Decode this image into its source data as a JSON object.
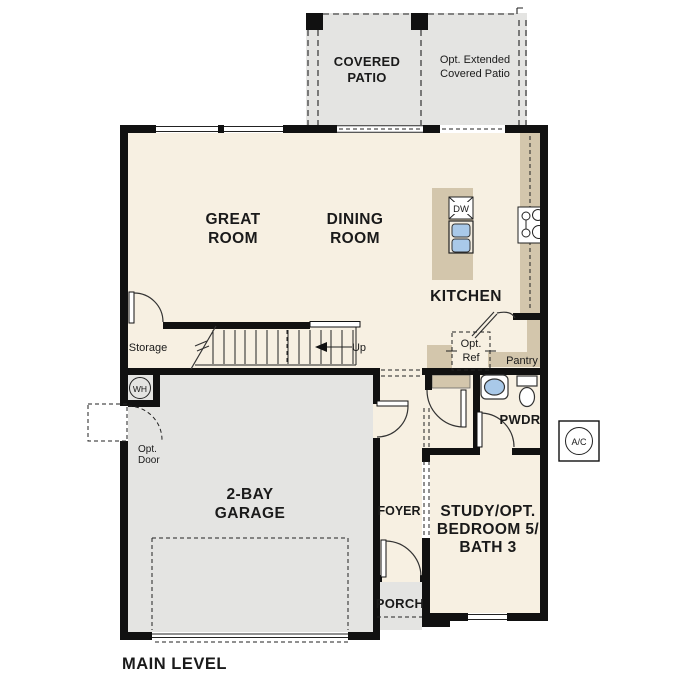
{
  "plan_title": "MAIN LEVEL",
  "colors": {
    "floor": "#f7f0e2",
    "concrete": "#e4e4e2",
    "counter": "#d3c6ac",
    "wall": "#111111",
    "fixture_blue": "#a9c9e9",
    "optref_fill": "#e8e8e6"
  },
  "areas": {
    "covered_patio": {
      "line1": "COVERED",
      "line2": "PATIO"
    },
    "extended_patio": {
      "line1": "Opt. Extended",
      "line2": "Covered Patio"
    },
    "great_room": {
      "line1": "GREAT",
      "line2": "ROOM"
    },
    "dining_room": {
      "line1": "DINING",
      "line2": "ROOM"
    },
    "kitchen": {
      "label": "KITCHEN"
    },
    "pantry": {
      "label": "Pantry"
    },
    "powder": {
      "label": "PWDR"
    },
    "storage": {
      "label": "Storage"
    },
    "garage": {
      "line1": "2-BAY",
      "line2": "GARAGE"
    },
    "foyer": {
      "label": "FOYER"
    },
    "study": {
      "line1": "STUDY/OPT.",
      "line2": "BEDROOM 5/",
      "line3": "BATH 3"
    },
    "porch": {
      "label": "PORCH"
    }
  },
  "annotations": {
    "stairs_up": "Up",
    "opt_ref": {
      "line1": "Opt.",
      "line2": "Ref"
    },
    "opt_door": {
      "line1": "Opt.",
      "line2": "Door"
    },
    "water_heater": "WH",
    "ac_unit": "A/C",
    "dishwasher": "DW"
  }
}
